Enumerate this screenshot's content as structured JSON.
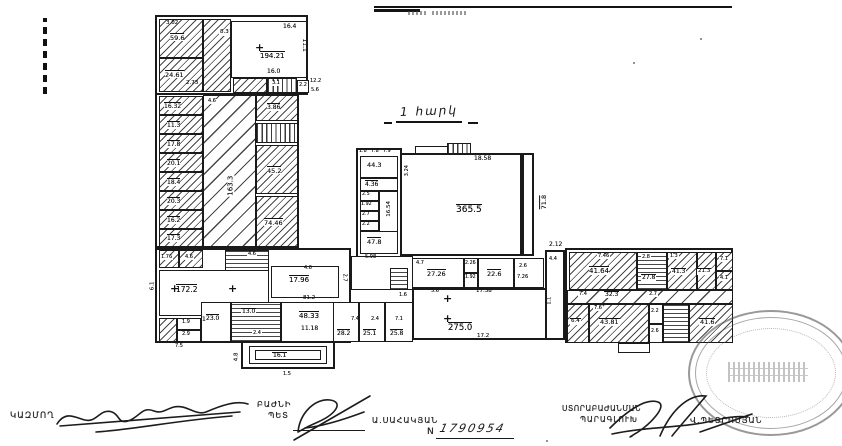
{
  "document": {
    "floor_title": "1 հարկ",
    "sheet_no_label": "N",
    "sheet_no": "1790954",
    "signatures": {
      "left_role": "ԿԱԶՄՈՂ",
      "middle_role_line1": "ԲԱԺՆԻ",
      "middle_role_line2": "ՊԵՏ",
      "middle_name": "Ա.ՍԱՀԱԿՅԱՆ",
      "right_role_line1": "ՍՏՈՐԱԲԱԺԱՆՄԱՆ",
      "right_role_line2": "ՊԱՐԱԳԼՈՒԽ",
      "right_name": "Վ.ՊԵՏՐՈՍՅԱՆ"
    }
  },
  "plan": {
    "ink": "#161616",
    "rooms": [
      {
        "x": 155,
        "y": 15,
        "w": 153,
        "h": 80,
        "c": "t"
      },
      {
        "x": 159,
        "y": 19,
        "w": 44,
        "h": 39,
        "c": "h"
      },
      {
        "x": 159,
        "y": 58,
        "w": 44,
        "h": 34,
        "c": "h"
      },
      {
        "x": 203,
        "y": 19,
        "w": 28,
        "h": 73,
        "c": "h"
      },
      {
        "x": 231,
        "y": 21,
        "w": 76,
        "h": 57,
        "c": ""
      },
      {
        "x": 233,
        "y": 78,
        "w": 34,
        "h": 15,
        "c": "h"
      },
      {
        "x": 267,
        "y": 78,
        "w": 30,
        "h": 15,
        "c": "sv"
      },
      {
        "x": 297,
        "y": 80,
        "w": 12,
        "h": 13,
        "c": ""
      },
      {
        "x": 155,
        "y": 93,
        "w": 144,
        "h": 155,
        "c": "t"
      },
      {
        "x": 159,
        "y": 96,
        "w": 44,
        "h": 19,
        "c": "h"
      },
      {
        "x": 159,
        "y": 115,
        "w": 44,
        "h": 19,
        "c": "h"
      },
      {
        "x": 159,
        "y": 134,
        "w": 44,
        "h": 19,
        "c": "h"
      },
      {
        "x": 159,
        "y": 153,
        "w": 44,
        "h": 19,
        "c": "h"
      },
      {
        "x": 159,
        "y": 172,
        "w": 44,
        "h": 19,
        "c": "h"
      },
      {
        "x": 159,
        "y": 191,
        "w": 44,
        "h": 19,
        "c": "h"
      },
      {
        "x": 159,
        "y": 210,
        "w": 44,
        "h": 19,
        "c": "h"
      },
      {
        "x": 159,
        "y": 229,
        "w": 44,
        "h": 18,
        "c": "h"
      },
      {
        "x": 203,
        "y": 95,
        "w": 53,
        "h": 152,
        "c": "hw"
      },
      {
        "x": 256,
        "y": 95,
        "w": 42,
        "h": 26,
        "c": "h"
      },
      {
        "x": 256,
        "y": 123,
        "w": 42,
        "h": 20,
        "c": "sv"
      },
      {
        "x": 256,
        "y": 145,
        "w": 42,
        "h": 49,
        "c": "h"
      },
      {
        "x": 256,
        "y": 196,
        "w": 42,
        "h": 51,
        "c": "h"
      },
      {
        "x": 155,
        "y": 248,
        "w": 196,
        "h": 95,
        "c": "t"
      },
      {
        "x": 159,
        "y": 250,
        "w": 20,
        "h": 18,
        "c": "h"
      },
      {
        "x": 179,
        "y": 250,
        "w": 24,
        "h": 18,
        "c": "h"
      },
      {
        "x": 225,
        "y": 250,
        "w": 44,
        "h": 27,
        "c": "st"
      },
      {
        "x": 159,
        "y": 270,
        "w": 110,
        "h": 46,
        "c": ""
      },
      {
        "x": 271,
        "y": 266,
        "w": 68,
        "h": 32,
        "c": ""
      },
      {
        "x": 159,
        "y": 318,
        "w": 18,
        "h": 24,
        "c": "h"
      },
      {
        "x": 177,
        "y": 318,
        "w": 24,
        "h": 12,
        "c": ""
      },
      {
        "x": 177,
        "y": 330,
        "w": 24,
        "h": 12,
        "c": ""
      },
      {
        "x": 201,
        "y": 302,
        "w": 30,
        "h": 40,
        "c": ""
      },
      {
        "x": 231,
        "y": 302,
        "w": 50,
        "h": 40,
        "c": "st"
      },
      {
        "x": 281,
        "y": 302,
        "w": 70,
        "h": 40,
        "c": ""
      },
      {
        "x": 241,
        "y": 341,
        "w": 94,
        "h": 28,
        "c": "t"
      },
      {
        "x": 249,
        "y": 346,
        "w": 78,
        "h": 18,
        "c": ""
      },
      {
        "x": 255,
        "y": 350,
        "w": 66,
        "h": 10,
        "c": ""
      },
      {
        "x": 333,
        "y": 302,
        "w": 26,
        "h": 40,
        "c": ""
      },
      {
        "x": 359,
        "y": 302,
        "w": 26,
        "h": 40,
        "c": ""
      },
      {
        "x": 385,
        "y": 302,
        "w": 28,
        "h": 40,
        "c": ""
      },
      {
        "x": 356,
        "y": 148,
        "w": 46,
        "h": 110,
        "c": "t"
      },
      {
        "x": 360,
        "y": 156,
        "w": 38,
        "h": 22,
        "c": ""
      },
      {
        "x": 360,
        "y": 178,
        "w": 38,
        "h": 13,
        "c": ""
      },
      {
        "x": 360,
        "y": 191,
        "w": 19,
        "h": 10,
        "c": ""
      },
      {
        "x": 360,
        "y": 201,
        "w": 19,
        "h": 10,
        "c": ""
      },
      {
        "x": 360,
        "y": 211,
        "w": 19,
        "h": 10,
        "c": ""
      },
      {
        "x": 360,
        "y": 221,
        "w": 19,
        "h": 10,
        "c": ""
      },
      {
        "x": 379,
        "y": 191,
        "w": 19,
        "h": 48,
        "c": ""
      },
      {
        "x": 360,
        "y": 231,
        "w": 38,
        "h": 23,
        "c": ""
      },
      {
        "x": 400,
        "y": 153,
        "w": 122,
        "h": 103,
        "c": "t"
      },
      {
        "x": 415,
        "y": 146,
        "w": 42,
        "h": 8,
        "c": ""
      },
      {
        "x": 447,
        "y": 143,
        "w": 24,
        "h": 11,
        "c": "sv"
      },
      {
        "x": 522,
        "y": 153,
        "w": 12,
        "h": 103,
        "c": "t"
      },
      {
        "x": 351,
        "y": 256,
        "w": 62,
        "h": 34,
        "c": ""
      },
      {
        "x": 390,
        "y": 268,
        "w": 18,
        "h": 22,
        "c": "st"
      },
      {
        "x": 412,
        "y": 258,
        "w": 52,
        "h": 30,
        "c": ""
      },
      {
        "x": 464,
        "y": 258,
        "w": 14,
        "h": 15,
        "c": ""
      },
      {
        "x": 464,
        "y": 273,
        "w": 14,
        "h": 15,
        "c": ""
      },
      {
        "x": 478,
        "y": 258,
        "w": 36,
        "h": 30,
        "c": ""
      },
      {
        "x": 514,
        "y": 258,
        "w": 30,
        "h": 30,
        "c": ""
      },
      {
        "x": 412,
        "y": 288,
        "w": 141,
        "h": 52,
        "c": "t"
      },
      {
        "x": 545,
        "y": 250,
        "w": 20,
        "h": 90,
        "c": "t"
      },
      {
        "x": 565,
        "y": 248,
        "w": 168,
        "h": 95,
        "c": "t"
      },
      {
        "x": 569,
        "y": 252,
        "w": 68,
        "h": 38,
        "c": "h"
      },
      {
        "x": 637,
        "y": 252,
        "w": 30,
        "h": 38,
        "c": "st"
      },
      {
        "x": 667,
        "y": 252,
        "w": 30,
        "h": 38,
        "c": "h"
      },
      {
        "x": 697,
        "y": 252,
        "w": 19,
        "h": 38,
        "c": "h"
      },
      {
        "x": 716,
        "y": 252,
        "w": 17,
        "h": 19,
        "c": "h"
      },
      {
        "x": 716,
        "y": 271,
        "w": 17,
        "h": 19,
        "c": "h"
      },
      {
        "x": 567,
        "y": 290,
        "w": 166,
        "h": 14,
        "c": "hw"
      },
      {
        "x": 567,
        "y": 304,
        "w": 22,
        "h": 39,
        "c": "h"
      },
      {
        "x": 589,
        "y": 304,
        "w": 60,
        "h": 39,
        "c": "h"
      },
      {
        "x": 649,
        "y": 304,
        "w": 14,
        "h": 20,
        "c": ""
      },
      {
        "x": 649,
        "y": 324,
        "w": 14,
        "h": 19,
        "c": ""
      },
      {
        "x": 663,
        "y": 304,
        "w": 26,
        "h": 39,
        "c": "st"
      },
      {
        "x": 689,
        "y": 304,
        "w": 44,
        "h": 39,
        "c": "h"
      },
      {
        "x": 618,
        "y": 343,
        "w": 32,
        "h": 10,
        "c": ""
      }
    ],
    "crosses": [
      {
        "x": 255,
        "y": 42
      },
      {
        "x": 170,
        "y": 283
      },
      {
        "x": 228,
        "y": 283
      },
      {
        "x": 443,
        "y": 293
      },
      {
        "x": 443,
        "y": 313
      }
    ],
    "labels": [
      {
        "t": "3.02",
        "x": 166,
        "y": 21,
        "s": 5.5
      },
      {
        "t": "59.6",
        "x": 170,
        "y": 33,
        "c": "ov"
      },
      {
        "t": "24.61",
        "x": 165,
        "y": 70,
        "c": "ov"
      },
      {
        "t": "2.73",
        "x": 186,
        "y": 81,
        "s": 5.5
      },
      {
        "t": "8.3",
        "x": 219,
        "y": 30,
        "s": 5.5,
        "c": "chip"
      },
      {
        "t": "16.4",
        "x": 283,
        "y": 24,
        "s": 6
      },
      {
        "t": "194.21",
        "x": 260,
        "y": 51,
        "c": "ov",
        "s": 7
      },
      {
        "t": "16.0",
        "x": 267,
        "y": 69,
        "s": 6
      },
      {
        "t": "11.1",
        "x": 297,
        "y": 42,
        "r": 90,
        "s": 6
      },
      {
        "t": "3.1",
        "x": 271,
        "y": 81,
        "s": 5,
        "c": "chip"
      },
      {
        "t": "2.2",
        "x": 299,
        "y": 83,
        "s": 5
      },
      {
        "t": "12.2",
        "x": 310,
        "y": 79,
        "s": 5
      },
      {
        "t": "5.6",
        "x": 311,
        "y": 88,
        "s": 5
      },
      {
        "t": "16.32",
        "x": 164,
        "y": 102,
        "c": "ov",
        "s": 6
      },
      {
        "t": "11.3",
        "x": 167,
        "y": 121,
        "c": "ov",
        "s": 6
      },
      {
        "t": "17.8",
        "x": 167,
        "y": 140,
        "c": "ov",
        "s": 6
      },
      {
        "t": "20.1",
        "x": 167,
        "y": 159,
        "c": "ov",
        "s": 6
      },
      {
        "t": "18.4",
        "x": 167,
        "y": 178,
        "c": "ov",
        "s": 6
      },
      {
        "t": "20.3",
        "x": 167,
        "y": 197,
        "c": "ov",
        "s": 6
      },
      {
        "t": "16.2",
        "x": 167,
        "y": 216,
        "c": "ov",
        "s": 6
      },
      {
        "t": "17.3",
        "x": 167,
        "y": 234,
        "c": "ov",
        "s": 6
      },
      {
        "t": "163.3",
        "x": 220,
        "y": 182,
        "r": -90,
        "s": 7,
        "c": "chip"
      },
      {
        "t": "4.6",
        "x": 207,
        "y": 99,
        "s": 5,
        "c": "chip"
      },
      {
        "t": "3.86",
        "x": 267,
        "y": 103,
        "c": "ov",
        "s": 6
      },
      {
        "t": "45.2",
        "x": 267,
        "y": 166,
        "c": "ov",
        "s": 6.5
      },
      {
        "t": "74.46",
        "x": 264,
        "y": 218,
        "c": "ov",
        "s": 6.5
      },
      {
        "t": "1.76",
        "x": 160,
        "y": 255,
        "s": 5,
        "c": "chip"
      },
      {
        "t": "4.6",
        "x": 184,
        "y": 255,
        "s": 5,
        "c": "chip"
      },
      {
        "t": "4.6",
        "x": 247,
        "y": 252,
        "s": 5,
        "c": "chip"
      },
      {
        "t": "172.2",
        "x": 176,
        "y": 284,
        "c": "ov",
        "s": 7.5
      },
      {
        "t": "14.4",
        "x": 202,
        "y": 317,
        "s": 6
      },
      {
        "t": "6.1",
        "x": 149,
        "y": 283,
        "r": -90,
        "s": 5.5
      },
      {
        "t": "17.96",
        "x": 289,
        "y": 275,
        "c": "ov",
        "s": 7
      },
      {
        "t": "4.6",
        "x": 304,
        "y": 266,
        "s": 5
      },
      {
        "t": "2.7",
        "x": 340,
        "y": 275,
        "r": 90,
        "s": 5
      },
      {
        "t": "81.2",
        "x": 303,
        "y": 296,
        "s": 5.5
      },
      {
        "t": "1.9",
        "x": 182,
        "y": 320,
        "s": 5
      },
      {
        "t": "2.9",
        "x": 182,
        "y": 332,
        "s": 5
      },
      {
        "t": "23.0",
        "x": 206,
        "y": 314,
        "c": "ov",
        "s": 6
      },
      {
        "t": "13.0",
        "x": 241,
        "y": 308,
        "c": "ov chip",
        "s": 6
      },
      {
        "t": "2.4",
        "x": 252,
        "y": 331,
        "s": 5,
        "c": "chip"
      },
      {
        "t": "48.33",
        "x": 299,
        "y": 311,
        "c": "ov",
        "s": 7
      },
      {
        "t": "11.18",
        "x": 301,
        "y": 326,
        "s": 6
      },
      {
        "t": "16.1",
        "x": 272,
        "y": 352,
        "c": "ov chip",
        "s": 6
      },
      {
        "t": "4.8",
        "x": 233,
        "y": 354,
        "r": -90,
        "s": 5.5
      },
      {
        "t": "1.5",
        "x": 283,
        "y": 372,
        "s": 5
      },
      {
        "t": "7.5",
        "x": 175,
        "y": 344,
        "s": 5
      },
      {
        "t": "28.2",
        "x": 337,
        "y": 329,
        "c": "ov",
        "s": 6
      },
      {
        "t": "25.1",
        "x": 363,
        "y": 329,
        "c": "ov",
        "s": 6
      },
      {
        "t": "25.8",
        "x": 390,
        "y": 329,
        "c": "ov",
        "s": 6
      },
      {
        "t": "7.4",
        "x": 351,
        "y": 317,
        "s": 5
      },
      {
        "t": "2.4",
        "x": 371,
        "y": 317,
        "s": 5
      },
      {
        "t": "7.1",
        "x": 395,
        "y": 317,
        "s": 5
      },
      {
        "t": "1.8",
        "x": 359,
        "y": 149,
        "s": 4.8
      },
      {
        "t": "7.8",
        "x": 371,
        "y": 149,
        "s": 4.8
      },
      {
        "t": "7.9",
        "x": 383,
        "y": 149,
        "s": 4.8
      },
      {
        "t": "44.3",
        "x": 367,
        "y": 162,
        "s": 6.5
      },
      {
        "t": "4.36",
        "x": 365,
        "y": 180,
        "c": "ov",
        "s": 6
      },
      {
        "t": "2.5",
        "x": 362,
        "y": 192,
        "s": 4.8
      },
      {
        "t": "1.92",
        "x": 361,
        "y": 202,
        "s": 4.8
      },
      {
        "t": "2.7",
        "x": 362,
        "y": 212,
        "s": 4.8
      },
      {
        "t": "2.2",
        "x": 362,
        "y": 222,
        "s": 4.8
      },
      {
        "t": "16.54",
        "x": 382,
        "y": 206,
        "r": -90,
        "s": 5.5
      },
      {
        "t": "47.8",
        "x": 367,
        "y": 237,
        "c": "ov",
        "s": 6.5
      },
      {
        "t": "5.98",
        "x": 365,
        "y": 255,
        "s": 5
      },
      {
        "t": "18.58",
        "x": 474,
        "y": 156,
        "s": 6
      },
      {
        "t": "3.24",
        "x": 402,
        "y": 168,
        "r": -90,
        "s": 5
      },
      {
        "t": "365.5",
        "x": 456,
        "y": 204,
        "c": "ov",
        "s": 9
      },
      {
        "t": "71.8",
        "x": 536,
        "y": 198,
        "r": -90,
        "c": "ov",
        "s": 6.5
      },
      {
        "t": "2.12",
        "x": 549,
        "y": 242,
        "s": 6
      },
      {
        "t": "27.26",
        "x": 427,
        "y": 269,
        "c": "ov",
        "s": 6.5
      },
      {
        "t": "4.7",
        "x": 416,
        "y": 261,
        "s": 5
      },
      {
        "t": "2.26",
        "x": 465,
        "y": 261,
        "s": 4.8
      },
      {
        "t": "1.92",
        "x": 465,
        "y": 275,
        "s": 4.8
      },
      {
        "t": "22.6",
        "x": 487,
        "y": 269,
        "c": "ov",
        "s": 6.5
      },
      {
        "t": "2.6",
        "x": 519,
        "y": 264,
        "s": 5
      },
      {
        "t": "7.26",
        "x": 517,
        "y": 275,
        "s": 5
      },
      {
        "t": "5.6",
        "x": 431,
        "y": 289,
        "s": 5
      },
      {
        "t": "1.6",
        "x": 399,
        "y": 293,
        "s": 5
      },
      {
        "t": "17.38",
        "x": 476,
        "y": 289,
        "s": 5.5
      },
      {
        "t": "275.0",
        "x": 448,
        "y": 322,
        "c": "ov",
        "s": 8.5
      },
      {
        "t": "17.2",
        "x": 477,
        "y": 334,
        "s": 5.5
      },
      {
        "t": "4.4",
        "x": 549,
        "y": 257,
        "s": 5
      },
      {
        "t": "1.1",
        "x": 546,
        "y": 298,
        "r": -90,
        "s": 5
      },
      {
        "t": "7.46",
        "x": 597,
        "y": 254,
        "s": 5,
        "c": "chip"
      },
      {
        "t": "41.64",
        "x": 589,
        "y": 266,
        "c": "ov",
        "s": 7
      },
      {
        "t": "27.8",
        "x": 641,
        "y": 274,
        "c": "ov chip",
        "s": 6
      },
      {
        "t": "2.8",
        "x": 641,
        "y": 255,
        "s": 5,
        "c": "chip"
      },
      {
        "t": "41.3",
        "x": 671,
        "y": 268,
        "c": "ov chip",
        "s": 6
      },
      {
        "t": "1.3",
        "x": 669,
        "y": 254,
        "s": 4.8,
        "c": "chip"
      },
      {
        "t": "21.3",
        "x": 697,
        "y": 268,
        "c": "ov chip",
        "s": 5.5
      },
      {
        "t": "7.1",
        "x": 719,
        "y": 257,
        "s": 5,
        "c": "chip"
      },
      {
        "t": "4.1",
        "x": 719,
        "y": 276,
        "s": 5,
        "c": "chip"
      },
      {
        "t": "32.3",
        "x": 604,
        "y": 291,
        "c": "ov chip",
        "s": 6
      },
      {
        "t": "7.4",
        "x": 578,
        "y": 292,
        "s": 5,
        "c": "chip"
      },
      {
        "t": "2.7",
        "x": 648,
        "y": 292,
        "s": 5,
        "c": "chip"
      },
      {
        "t": "6.4",
        "x": 570,
        "y": 318,
        "c": "ov chip",
        "s": 5.5
      },
      {
        "t": "43.81",
        "x": 599,
        "y": 318,
        "c": "ov chip",
        "s": 6.5
      },
      {
        "t": "7.6",
        "x": 593,
        "y": 306,
        "s": 5,
        "c": "chip"
      },
      {
        "t": "2.2",
        "x": 651,
        "y": 309,
        "s": 4.8
      },
      {
        "t": "2.6",
        "x": 651,
        "y": 329,
        "s": 4.8
      },
      {
        "t": "41.6",
        "x": 699,
        "y": 318,
        "c": "ov chip",
        "s": 6.5
      }
    ]
  }
}
